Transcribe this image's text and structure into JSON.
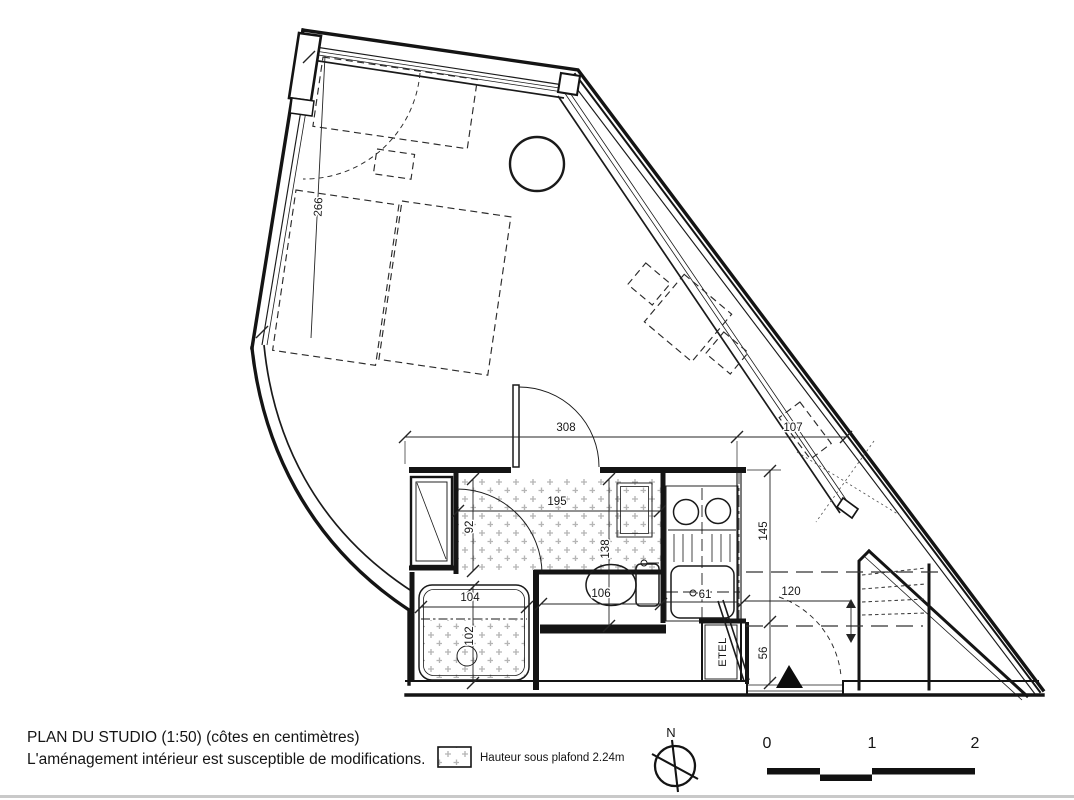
{
  "title": {
    "line1": "PLAN DU STUDIO (1:50) (côtes en centimètres)",
    "line2": "L'aménagement intérieur est susceptible de modifications."
  },
  "legend": {
    "ceiling_label": "Hauteur sous plafond 2.24m"
  },
  "compass": {
    "north": "N"
  },
  "scale_bar": {
    "labels": [
      "0",
      "1",
      "2"
    ]
  },
  "closet": {
    "label": "ETEL"
  },
  "dims": {
    "living_height": "266",
    "band_width": "308",
    "entry_width": "107",
    "corridor_length": "195",
    "corridor_width": "92",
    "wc_depth": "138",
    "shower_width": "104",
    "shower_depth": "102",
    "wc_width": "106",
    "sink_width": "61",
    "right_depth": "145",
    "wardrobe_dist": "120",
    "door_offset": "56"
  },
  "colors": {
    "line": "#141414",
    "hatch": "#b5b5b5",
    "page_edge": "#c9c9c9"
  }
}
